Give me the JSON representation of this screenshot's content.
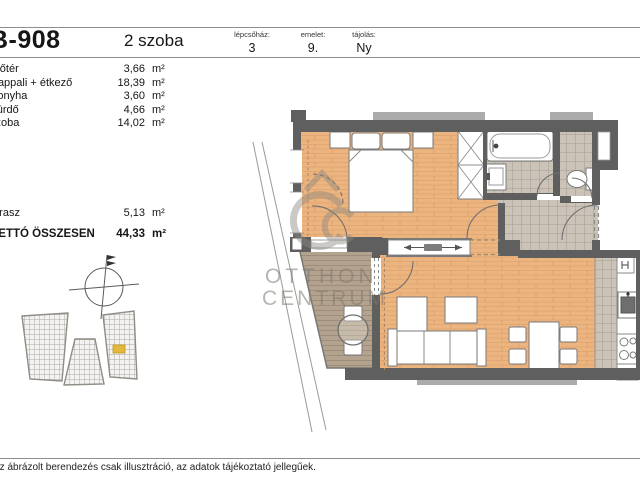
{
  "header": {
    "unit_id": "B-908",
    "room_count": "2 szoba",
    "meta": [
      {
        "label": "lépcsőház:",
        "value": "3"
      },
      {
        "label": "emelet:",
        "value": "9."
      },
      {
        "label": "tájolás:",
        "value": "Ny"
      }
    ]
  },
  "rooms": [
    {
      "name": "Előtér",
      "area": "3,66",
      "unit": "m²"
    },
    {
      "name": "Nappali + étkező",
      "area": "18,39",
      "unit": "m²"
    },
    {
      "name": "Konyha",
      "area": "3,60",
      "unit": "m²"
    },
    {
      "name": "Fürdő",
      "area": "4,66",
      "unit": "m²"
    },
    {
      "name": "szoba",
      "area": "14,02",
      "unit": "m²"
    }
  ],
  "terrace_row": {
    "name": "terasz",
    "area": "5,13",
    "unit": "m²"
  },
  "total_row": {
    "name": "NETTÓ ÖSSZESEN",
    "area": "44,33",
    "unit": "m²"
  },
  "watermark": {
    "line1": "OTTHON",
    "line2": "CENTRUM"
  },
  "footer": {
    "disclaimer": "Az ábrázolt berendezés csak illusztráció, az adatok tájékoztató jellegűek."
  },
  "site_key": {
    "highlight_color": "#e3b83d"
  },
  "colors": {
    "wall": "#5f5f5f",
    "wood_floor": "#ecb47f",
    "tile_floor": "#cbc3b8",
    "deck_floor": "#b3a38e",
    "line": "#8e8e8e",
    "watermark": "#8d887f"
  }
}
